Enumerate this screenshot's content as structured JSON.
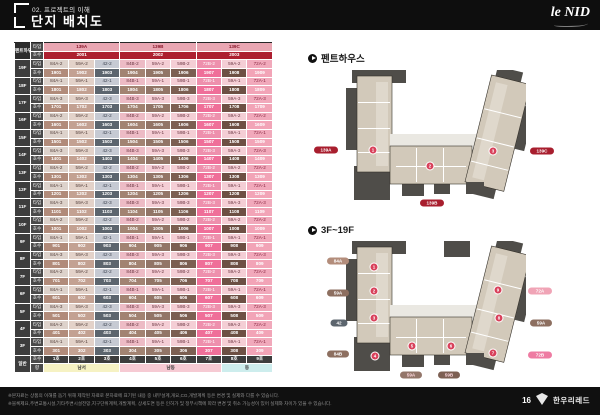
{
  "header": {
    "kicker": "02. 프로젝트의 이해",
    "title": "단지 배치도",
    "logo": "le NID"
  },
  "table": {
    "corner": "펜트하우스",
    "type_label": "타입",
    "unit_label": "호수",
    "general_label": "일반",
    "direction_label": "향",
    "penthouse": {
      "types": [
        "139A",
        "139B",
        "139C"
      ],
      "units": [
        "2001",
        "2002",
        "2003"
      ]
    },
    "floors": [
      {
        "floor": "19F",
        "types": [
          "84A-2",
          "59A-2",
          "42-2",
          "84B-2",
          "59A-2",
          "59B-2",
          "72B-2",
          "59A-2",
          "72A-2"
        ],
        "units": [
          "1901",
          "1902",
          "1903",
          "1904",
          "1905",
          "1906",
          "1907",
          "1908",
          "1909"
        ]
      },
      {
        "floor": "18F",
        "types": [
          "84A-1",
          "59A-1",
          "42-1",
          "84B-1",
          "59A-1",
          "59B-1",
          "72B-1",
          "59A-1",
          "72A-1"
        ],
        "units": [
          "1801",
          "1802",
          "1803",
          "1804",
          "1805",
          "1806",
          "1807",
          "1808",
          "1809"
        ]
      },
      {
        "floor": "17F",
        "types": [
          "84A-3",
          "59A-3",
          "42-3",
          "84B-3",
          "59A-3",
          "59B-3",
          "72B-3",
          "59A-3",
          "72A-3"
        ],
        "units": [
          "1701",
          "1702",
          "1703",
          "1704",
          "1705",
          "1706",
          "1707",
          "1708",
          "1709"
        ]
      },
      {
        "floor": "16F",
        "types": [
          "84A-2",
          "59A-2",
          "42-2",
          "84B-2",
          "59A-2",
          "59B-2",
          "72B-2",
          "59A-2",
          "72A-2"
        ],
        "units": [
          "1601",
          "1602",
          "1603",
          "1604",
          "1605",
          "1606",
          "1607",
          "1608",
          "1609"
        ]
      },
      {
        "floor": "15F",
        "types": [
          "84A-1",
          "59A-1",
          "42-1",
          "84B-1",
          "59A-1",
          "59B-1",
          "72B-1",
          "59A-1",
          "72A-1"
        ],
        "units": [
          "1501",
          "1502",
          "1503",
          "1504",
          "1505",
          "1506",
          "1507",
          "1508",
          "1509"
        ]
      },
      {
        "floor": "14F",
        "types": [
          "84A-3",
          "59A-3",
          "42-3",
          "84B-3",
          "59A-3",
          "59B-3",
          "72B-3",
          "59A-3",
          "72A-3"
        ],
        "units": [
          "1401",
          "1402",
          "1403",
          "1404",
          "1405",
          "1406",
          "1407",
          "1408",
          "1409"
        ]
      },
      {
        "floor": "13F",
        "types": [
          "84A-2",
          "59A-2",
          "42-2",
          "84B-2",
          "59A-2",
          "59B-2",
          "72B-2",
          "59A-2",
          "72A-2"
        ],
        "units": [
          "1301",
          "1302",
          "1303",
          "1304",
          "1305",
          "1306",
          "1307",
          "1308",
          "1309"
        ]
      },
      {
        "floor": "12F",
        "types": [
          "84A-1",
          "59A-1",
          "42-1",
          "84B-1",
          "59A-1",
          "59B-1",
          "72B-1",
          "59A-1",
          "72A-1"
        ],
        "units": [
          "1201",
          "1202",
          "1203",
          "1204",
          "1205",
          "1206",
          "1207",
          "1208",
          "1209"
        ]
      },
      {
        "floor": "11F",
        "types": [
          "84A-3",
          "59A-3",
          "42-3",
          "84B-3",
          "59A-3",
          "59B-3",
          "72B-3",
          "59A-3",
          "72A-3"
        ],
        "units": [
          "1101",
          "1102",
          "1103",
          "1104",
          "1105",
          "1106",
          "1107",
          "1108",
          "1109"
        ]
      },
      {
        "floor": "10F",
        "types": [
          "84A-2",
          "59A-2",
          "42-2",
          "84B-2",
          "59A-2",
          "59B-2",
          "72B-2",
          "59A-2",
          "72A-2"
        ],
        "units": [
          "1001",
          "1002",
          "1003",
          "1004",
          "1005",
          "1006",
          "1007",
          "1008",
          "1009"
        ]
      },
      {
        "floor": "9F",
        "types": [
          "84A-1",
          "59A-1",
          "42-1",
          "84B-1",
          "59A-1",
          "59B-1",
          "72B-1",
          "59A-1",
          "72A-1"
        ],
        "units": [
          "901",
          "902",
          "903",
          "904",
          "905",
          "906",
          "907",
          "908",
          "909"
        ]
      },
      {
        "floor": "8F",
        "types": [
          "84A-3",
          "59A-3",
          "42-3",
          "84B-3",
          "59A-3",
          "59B-3",
          "72B-3",
          "59A-3",
          "72A-3"
        ],
        "units": [
          "801",
          "802",
          "803",
          "804",
          "805",
          "806",
          "807",
          "808",
          "809"
        ]
      },
      {
        "floor": "7F",
        "types": [
          "84A-2",
          "59A-2",
          "42-2",
          "84B-2",
          "59A-2",
          "59B-2",
          "72B-2",
          "59A-2",
          "72A-2"
        ],
        "units": [
          "701",
          "702",
          "703",
          "704",
          "705",
          "706",
          "707",
          "708",
          "709"
        ]
      },
      {
        "floor": "6F",
        "types": [
          "84A-1",
          "59A-1",
          "42-1",
          "84B-1",
          "59A-1",
          "59B-1",
          "72B-1",
          "59A-1",
          "72A-1"
        ],
        "units": [
          "601",
          "602",
          "603",
          "604",
          "605",
          "606",
          "607",
          "608",
          "609"
        ]
      },
      {
        "floor": "5F",
        "types": [
          "84A-3",
          "59A-3",
          "42-3",
          "84B-3",
          "59A-3",
          "59B-3",
          "72B-3",
          "59A-3",
          "72A-3"
        ],
        "units": [
          "501",
          "502",
          "503",
          "504",
          "505",
          "506",
          "507",
          "508",
          "509"
        ]
      },
      {
        "floor": "4F",
        "types": [
          "84A-2",
          "59A-2",
          "42-2",
          "84B-2",
          "59A-2",
          "59B-2",
          "72B-2",
          "59A-2",
          "72A-2"
        ],
        "units": [
          "401",
          "402",
          "403",
          "404",
          "405",
          "406",
          "407",
          "408",
          "409"
        ]
      },
      {
        "floor": "3F",
        "types": [
          "84A-1",
          "59A-1",
          "42-1",
          "84B-1",
          "59A-1",
          "59B-1",
          "72B-1",
          "59A-1",
          "72A-1"
        ],
        "units": [
          "301",
          "302",
          "303",
          "304",
          "305",
          "306",
          "307",
          "308",
          "309"
        ]
      }
    ],
    "general": {
      "units": [
        "1호",
        "2호",
        "3호",
        "4호",
        "5호",
        "6호",
        "7호",
        "8호",
        "9호"
      ],
      "directions": [
        {
          "label": "남서",
          "span": 3,
          "bg": "#f6f2c3"
        },
        {
          "label": "남동",
          "span": 4,
          "bg": "#f6cad3"
        },
        {
          "label": "동",
          "span": 2,
          "bg": "#cdeded"
        }
      ]
    },
    "colors": {
      "type_bg": [
        "#ddd2cb",
        "#e3d2c9",
        "#c6cad3",
        "#edbbc5",
        "#f4ced5",
        "#f4ced5",
        "#ee90ad",
        "#f4ced5",
        "#f1a9bb"
      ],
      "type_fg": [
        "#55403c",
        "#55403c",
        "#3c4350",
        "#6b3642",
        "#6b3642",
        "#6b3642",
        "#ffffff",
        "#6b3642",
        "#8b2a44"
      ],
      "unit_bg": [
        "#b18b7a",
        "#c3a192",
        "#5c656e",
        "#a28372",
        "#927567",
        "#7c5f52",
        "#ef6f99",
        "#6d5044",
        "#f2a4b7"
      ],
      "unit_fg": "#ffffff",
      "ph_type_bg": "#e9a6b2",
      "ph_type_fg": "#8b1a2e",
      "ph_unit_bg": "#ad1f30",
      "ph_unit_fg": "#ffffff"
    }
  },
  "plans": {
    "penthouse": {
      "heading": "펜트하우스",
      "pills": [
        {
          "label": "139A",
          "x": 326,
          "y": 150,
          "w": 24,
          "bg": "#a81e2e",
          "fg": "#ffffff"
        },
        {
          "label": "139B",
          "x": 432,
          "y": 203,
          "w": 24,
          "bg": "#a81e2e",
          "fg": "#ffffff"
        },
        {
          "label": "139C",
          "x": 542,
          "y": 151,
          "w": 24,
          "bg": "#a81e2e",
          "fg": "#ffffff"
        }
      ],
      "badges": [
        {
          "n": "1",
          "x": 373,
          "y": 150
        },
        {
          "n": "2",
          "x": 430,
          "y": 166
        },
        {
          "n": "3",
          "x": 493,
          "y": 151
        }
      ]
    },
    "floors_plan": {
      "heading": "3F~19F",
      "pills": [
        {
          "label": "84A",
          "x": 338,
          "y": 261,
          "w": 22,
          "bg": "#b38d7b",
          "fg": "#ffffff"
        },
        {
          "label": "59A",
          "x": 338,
          "y": 293,
          "w": 22,
          "bg": "#8d6f60",
          "fg": "#ffffff"
        },
        {
          "label": "42",
          "x": 339,
          "y": 323,
          "w": 17,
          "bg": "#5c656e",
          "fg": "#ffffff"
        },
        {
          "label": "84B",
          "x": 338,
          "y": 354,
          "w": 22,
          "bg": "#8d6f60",
          "fg": "#ffffff"
        },
        {
          "label": "59A",
          "x": 411,
          "y": 375,
          "w": 22,
          "bg": "#93766a",
          "fg": "#ffd9e0"
        },
        {
          "label": "59B",
          "x": 449,
          "y": 375,
          "w": 22,
          "bg": "#7d6053",
          "fg": "#ffd9e0"
        },
        {
          "label": "72A",
          "x": 540,
          "y": 291,
          "w": 24,
          "bg": "#f0a4b6",
          "fg": "#ffffff"
        },
        {
          "label": "59A",
          "x": 541,
          "y": 323,
          "w": 22,
          "bg": "#8d6f60",
          "fg": "#ffffff"
        },
        {
          "label": "72B",
          "x": 540,
          "y": 355,
          "w": 24,
          "bg": "#ee7ba2",
          "fg": "#ffffff"
        }
      ],
      "badges": [
        {
          "n": "1",
          "x": 374,
          "y": 267
        },
        {
          "n": "2",
          "x": 374,
          "y": 291
        },
        {
          "n": "3",
          "x": 374,
          "y": 318
        },
        {
          "n": "4",
          "x": 375,
          "y": 356
        },
        {
          "n": "5",
          "x": 412,
          "y": 346
        },
        {
          "n": "6",
          "x": 451,
          "y": 346
        },
        {
          "n": "7",
          "x": 493,
          "y": 353
        },
        {
          "n": "8",
          "x": 499,
          "y": 318
        },
        {
          "n": "9",
          "x": 498,
          "y": 290
        }
      ]
    }
  },
  "footer": {
    "line1": "※본자료는 상품의 이해를 돕기 위해 제작된 자료로 본자료에 표기된 내용 중 내부설계,개요,CG,개발계획 등은 변경 및 실제와 다를 수 있습니다.",
    "line2": "※블록제요,주변교통시설,기타주변시설전망,지구단위계획,개발계획, 상세도면 등은 인허가 및 정부시책에 따라 변경 및 취소 가능성이 있어 실제와 차이가 있을 수 있습니다.",
    "page_number": "16",
    "brand": "한우리레드"
  }
}
